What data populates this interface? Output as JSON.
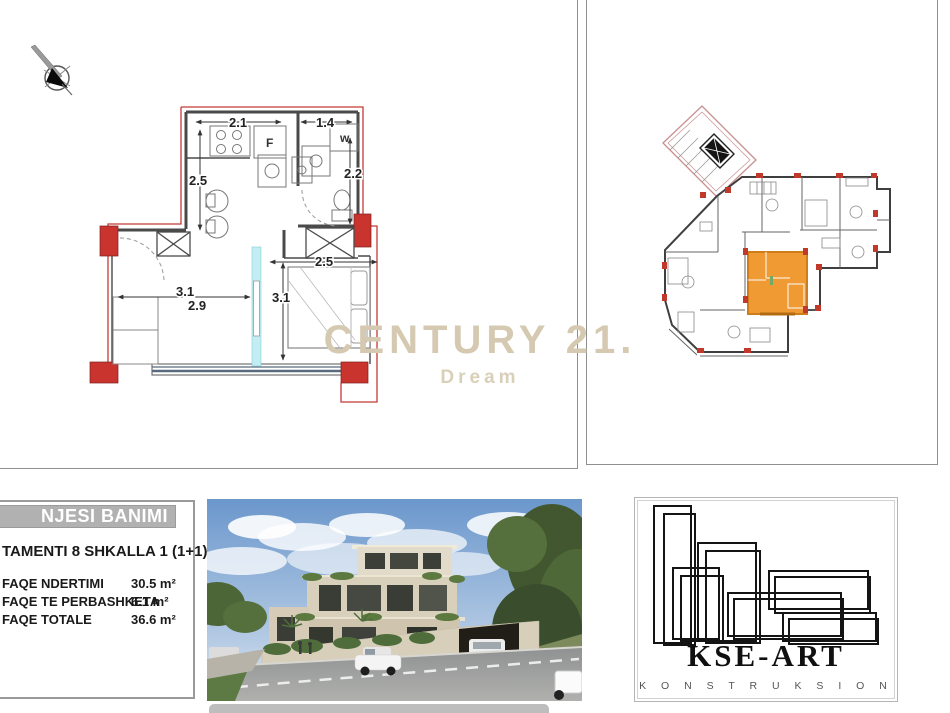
{
  "unit_plan": {
    "dim_kitchen_width": "2.1",
    "dim_bath_width": "1.4",
    "dim_kitchen_depth": "2.5",
    "dim_bath_depth": "2.2",
    "dim_bedroom_width": "2.5",
    "dim_living_width": "3.1",
    "dim_living_width2": "2.9",
    "dim_bedroom_depth": "3.1",
    "label_fridge": "F",
    "label_washer": "w"
  },
  "overview_plan": {
    "highlight_color": "#f09a33"
  },
  "watermark": {
    "line1": "CENTURY 21.",
    "line2": "Dream",
    "color": "#d5cab1"
  },
  "info_panel": {
    "title": "NJESI BANIMI",
    "subtitle": "TAMENTI 8 SHKALLA 1 (1+1)",
    "rows": [
      {
        "label": "FAQE NDERTIMI",
        "value": "30.5 m²"
      },
      {
        "label": "FAQE TE PERBASHKETA",
        "value": "6.1 m²"
      },
      {
        "label": "FAQE TOTALE",
        "value": "36.6 m²"
      }
    ]
  },
  "logo_panel": {
    "name": "KSE-ART",
    "subtitle": "K O N S T R U K S I O N"
  },
  "icons": {
    "north_arrow": "compass-needle"
  },
  "colors": {
    "column_red": "#c9342f",
    "highlight_orange": "#f09a33",
    "sliding_door_cyan": "#c2eef3",
    "watermark_beige": "#d5cab1",
    "titlebar_gray": "#b1b1b1"
  }
}
